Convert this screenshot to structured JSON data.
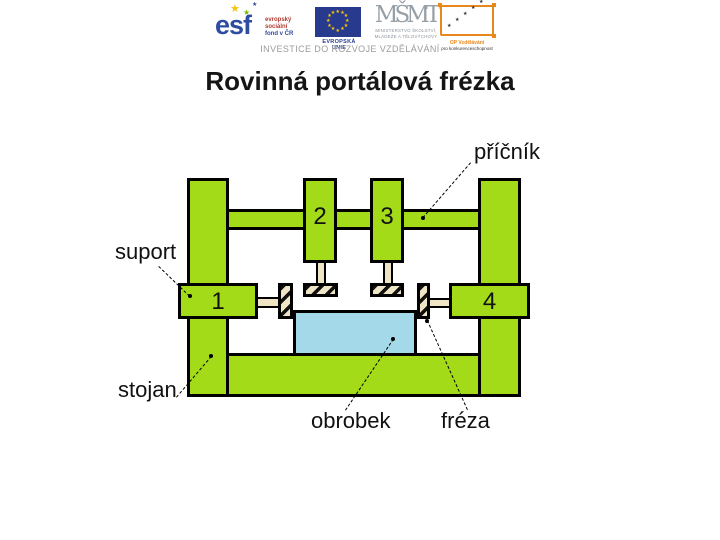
{
  "slide": {
    "title": "Rovinná portálová frézka"
  },
  "header": {
    "esf": {
      "wordmark": "esf",
      "caption": [
        "evropský",
        "sociální",
        "fond v ČR"
      ]
    },
    "eu": {
      "caption": "EVROPSKÁ UNIE"
    },
    "msmt": {
      "wordmark": "MŠMT",
      "caption": [
        "MINISTERSTVO ŠKOLSTVÍ,",
        "MLÁDEŽE A TĚLOVÝCHOVY"
      ]
    },
    "opvk": {
      "caption": [
        "OP Vzdělávání",
        "pro konkurenceschopnost"
      ]
    },
    "tagline": "INVESTICE DO ROZVOJE VZDĚLÁVÁNÍ"
  },
  "diagram": {
    "labels": {
      "pricnik": "příčník",
      "suport": "suport",
      "stojan": "stojan",
      "obrobek": "obrobek",
      "freza": "fréza"
    },
    "numbers": [
      "1",
      "2",
      "3",
      "4"
    ],
    "colors": {
      "machine_green": "#A3DB18",
      "workpiece_blue": "#A4D9E9",
      "spindle_beige": "#EFE5C5",
      "outline_black": "#000000"
    }
  },
  "icons": {
    "star": "★"
  }
}
